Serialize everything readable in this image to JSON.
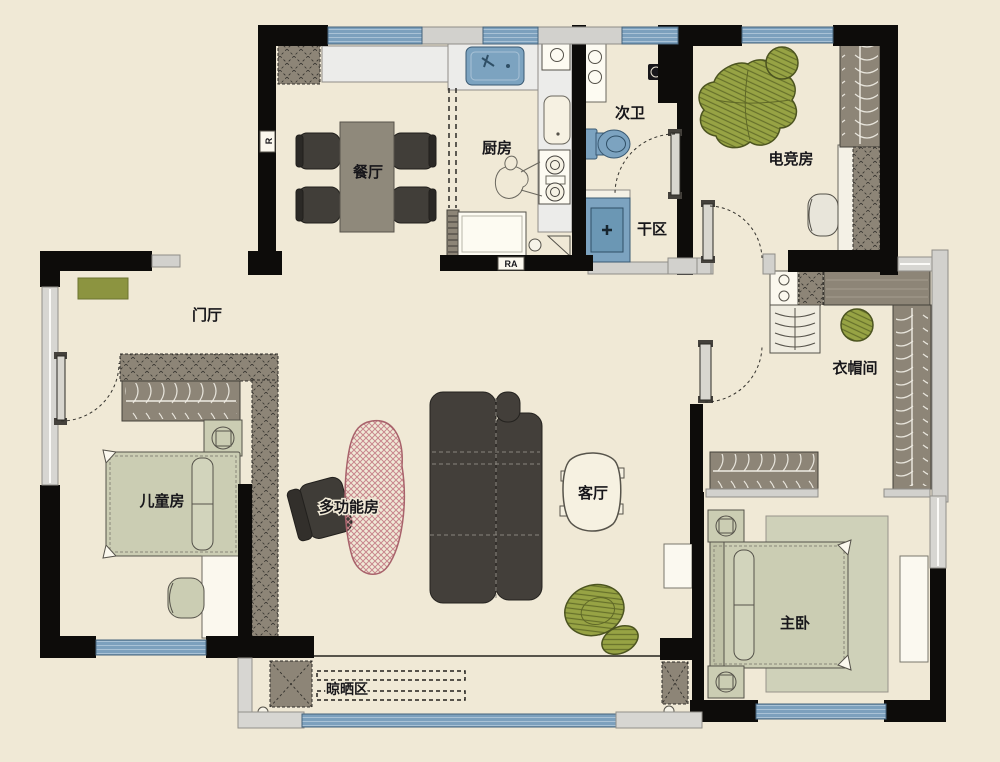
{
  "floorplan": {
    "rooms": {
      "dining": "餐厅",
      "kitchen": "厨房",
      "bath2": "次卫",
      "dry": "干区",
      "esports": "电竞房",
      "foyer": "门厅",
      "kids": "儿童房",
      "multi": "多功能房",
      "living": "客厅",
      "cloak": "衣帽间",
      "master": "主卧",
      "drying": "晾晒区"
    },
    "markers": {
      "r": "R",
      "ra": "RA"
    },
    "colors": {
      "background": "#f0e9d6",
      "wall": "#0d0c0a",
      "window_blue": "#7ca0bd",
      "window_frame_gray": "#d7d6d2",
      "fixture_blue": "#7ca3c0",
      "sofa_dark": "#433f3a",
      "green_furniture": "#97a344",
      "table_wood": "#8f897b",
      "wardrobe": "#8d8577",
      "bed_sage": "#cbcdb3",
      "rug_pink_hatch": "#c8868d",
      "doormat_green": "#8c9440"
    }
  }
}
